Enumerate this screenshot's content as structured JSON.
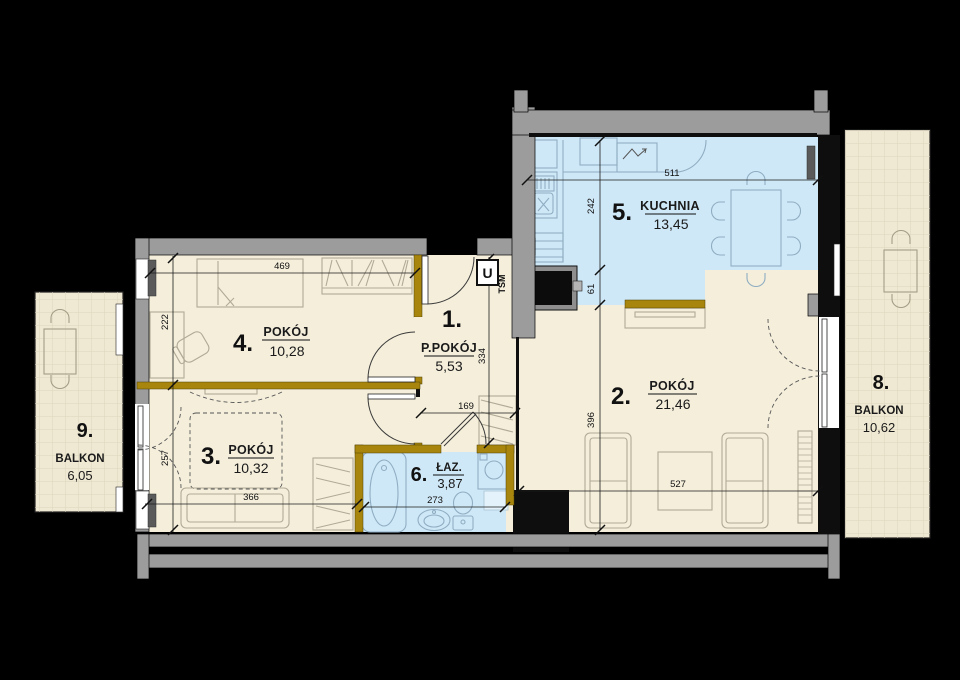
{
  "plan": {
    "rooms": [
      {
        "number": "1.",
        "name": "P.POKÓJ",
        "area": "5,53"
      },
      {
        "number": "2.",
        "name": "POKÓJ",
        "area": "21,46"
      },
      {
        "number": "3.",
        "name": "POKÓJ",
        "area": "10,32"
      },
      {
        "number": "4.",
        "name": "POKÓJ",
        "area": "10,28"
      },
      {
        "number": "5.",
        "name": "KUCHNIA",
        "area": "13,45"
      },
      {
        "number": "6.",
        "name": "ŁAZ.",
        "area": "3,87"
      },
      {
        "number": "8.",
        "name": "BALKON",
        "area": "10,62"
      },
      {
        "number": "9.",
        "name": "BALKON",
        "area": "6,05"
      }
    ],
    "dimensions": {
      "room4_width": "469",
      "room4_depth": "222",
      "room3_depth": "257",
      "room3_width": "366",
      "bathroom_width": "273",
      "hall_depth": "334",
      "hall_width": "169",
      "kitchen_width": "511",
      "kitchen_depth": "242",
      "kitchen_strip": "61",
      "room2_depth": "396",
      "room2_width": "527"
    },
    "markers": {
      "entrance": "U",
      "shaft": "TSM"
    },
    "colors": {
      "floor_cream": "#f4eedb",
      "floor_blue": "#cfe8f7",
      "floor_balcony": "#efe8d2",
      "wall_gray": "#9c9c9c",
      "wall_black": "#0e0e0e",
      "accent_gold": "#a8860d"
    }
  }
}
